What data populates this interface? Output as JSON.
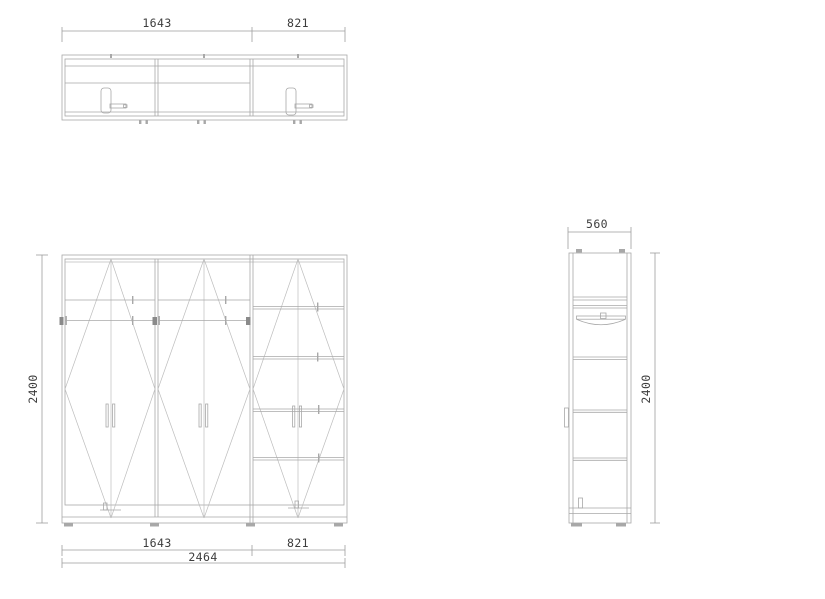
{
  "drawing": {
    "type": "furniture-technical-drawing",
    "subject": "wardrobe",
    "colors": {
      "background": "#ffffff",
      "line": "#a8a8a8",
      "line_light": "#bdbdbd",
      "line_dark": "#8a8a8a",
      "dimension": "#9e9e9e",
      "text": "#3d3d3d"
    },
    "plan_view": {
      "dim_left_width": "1643",
      "dim_right_width": "821"
    },
    "front_view": {
      "dim_height": "2400",
      "dim_left_width": "1643",
      "dim_right_width": "821",
      "dim_total_width": "2464"
    },
    "side_view": {
      "dim_depth": "560",
      "dim_height": "2400"
    }
  }
}
